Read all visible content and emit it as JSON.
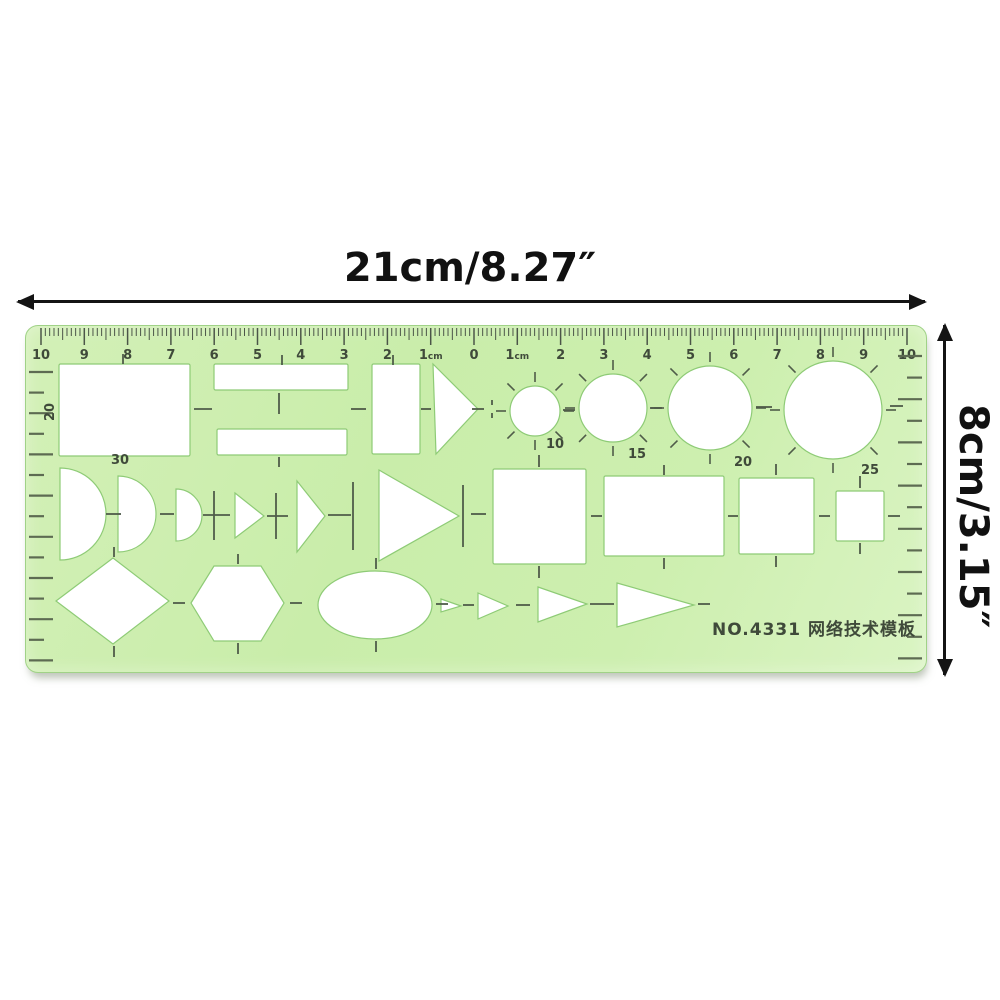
{
  "dimension_labels": {
    "width": "21cm/8.27″",
    "height": "8cm/3.15″"
  },
  "ruler": {
    "model_text": "NO.4331  网络技术模板",
    "model_pos": {
      "x": 788,
      "y": 309
    },
    "colors": {
      "body": "#cdefaf",
      "edge": "#a0d287",
      "tick": "#4b5548",
      "number": "#3f4a3a",
      "edge_tick": "#5d6b52",
      "guide": "#4f5c49",
      "cutout_fill": "#ffffff",
      "cutout_stroke": "#8ecb76"
    },
    "scale": {
      "unit": "cm",
      "origin_x": 448,
      "px_per_cm": 43.3,
      "mm_range": 100,
      "numbers": [
        {
          "cm": -10,
          "t": "10"
        },
        {
          "cm": -9,
          "t": "9"
        },
        {
          "cm": -8,
          "t": "8"
        },
        {
          "cm": -7,
          "t": "7"
        },
        {
          "cm": -6,
          "t": "6"
        },
        {
          "cm": -5,
          "t": "5"
        },
        {
          "cm": -4,
          "t": "4"
        },
        {
          "cm": -3,
          "t": "3"
        },
        {
          "cm": -2,
          "t": "2"
        },
        {
          "cm": -1,
          "t": "1",
          "suffix": "cm"
        },
        {
          "cm": 0,
          "t": "0"
        },
        {
          "cm": 1,
          "t": "1",
          "suffix": "cm"
        },
        {
          "cm": 2,
          "t": "2"
        },
        {
          "cm": 3,
          "t": "3"
        },
        {
          "cm": 4,
          "t": "4"
        },
        {
          "cm": 5,
          "t": "5"
        },
        {
          "cm": 6,
          "t": "6"
        },
        {
          "cm": 7,
          "t": "7"
        },
        {
          "cm": 8,
          "t": "8"
        },
        {
          "cm": 9,
          "t": "9"
        },
        {
          "cm": 10,
          "t": "10"
        }
      ]
    },
    "edge_ticks": {
      "left": {
        "x": 3,
        "y0": 46,
        "step": 20.6,
        "count": 15,
        "len_long": 24,
        "len_short": 15
      },
      "right": {
        "x_end": 896,
        "y0": 30,
        "step": 21.6,
        "count": 15,
        "len_long": 24,
        "len_short": 15
      }
    },
    "cutouts": [
      {
        "type": "rect",
        "x": 33,
        "y": 38,
        "w": 131,
        "h": 92
      },
      {
        "type": "rect",
        "x": 188,
        "y": 38,
        "w": 134,
        "h": 26
      },
      {
        "type": "rect",
        "x": 191,
        "y": 103,
        "w": 130,
        "h": 26
      },
      {
        "type": "rect",
        "x": 346,
        "y": 38,
        "w": 48,
        "h": 90
      },
      {
        "type": "poly",
        "pts": [
          [
            407,
            38
          ],
          [
            452,
            83
          ],
          [
            410,
            128
          ]
        ]
      },
      {
        "type": "circle",
        "cx": 509,
        "cy": 85,
        "r": 25,
        "radial_ticks": true
      },
      {
        "type": "circle",
        "cx": 587,
        "cy": 82,
        "r": 34,
        "radial_ticks": true
      },
      {
        "type": "circle",
        "cx": 684,
        "cy": 82,
        "r": 42,
        "radial_ticks": true
      },
      {
        "type": "circle",
        "cx": 807,
        "cy": 84,
        "r": 49,
        "radial_ticks": true
      },
      {
        "type": "halfcircle",
        "x": 34,
        "cy": 188,
        "r": 46
      },
      {
        "type": "halfcircle",
        "x": 92,
        "cy": 188,
        "r": 38
      },
      {
        "type": "halfcircle",
        "x": 150,
        "cy": 189,
        "r": 26
      },
      {
        "type": "poly",
        "pts": [
          [
            209,
            167
          ],
          [
            238,
            190
          ],
          [
            209,
            212
          ]
        ]
      },
      {
        "type": "poly",
        "pts": [
          [
            271,
            155
          ],
          [
            299,
            190
          ],
          [
            271,
            226
          ]
        ]
      },
      {
        "type": "poly",
        "pts": [
          [
            353,
            144
          ],
          [
            433,
            190
          ],
          [
            353,
            235
          ]
        ]
      },
      {
        "type": "rect",
        "x": 467,
        "y": 143,
        "w": 93,
        "h": 95
      },
      {
        "type": "rect",
        "x": 578,
        "y": 150,
        "w": 120,
        "h": 80
      },
      {
        "type": "rect",
        "x": 713,
        "y": 152,
        "w": 75,
        "h": 76
      },
      {
        "type": "rect",
        "x": 810,
        "y": 165,
        "w": 48,
        "h": 50
      },
      {
        "type": "poly",
        "pts": [
          [
            30,
            275
          ],
          [
            87,
            232
          ],
          [
            143,
            275
          ],
          [
            87,
            318
          ]
        ]
      },
      {
        "type": "poly",
        "pts": [
          [
            165,
            277
          ],
          [
            188,
            240
          ],
          [
            235,
            240
          ],
          [
            258,
            277
          ],
          [
            235,
            315
          ],
          [
            188,
            315
          ]
        ]
      },
      {
        "type": "ellipse",
        "cx": 349,
        "cy": 279,
        "rx": 57,
        "ry": 34
      },
      {
        "type": "poly",
        "pts": [
          [
            415,
            273
          ],
          [
            435,
            280
          ],
          [
            415,
            286
          ]
        ]
      },
      {
        "type": "poly",
        "pts": [
          [
            452,
            267
          ],
          [
            482,
            280
          ],
          [
            452,
            293
          ]
        ]
      },
      {
        "type": "poly",
        "pts": [
          [
            512,
            261
          ],
          [
            561,
            278
          ],
          [
            512,
            296
          ]
        ]
      },
      {
        "type": "poly",
        "pts": [
          [
            591,
            257
          ],
          [
            668,
            279
          ],
          [
            591,
            301
          ]
        ]
      }
    ],
    "guide_ticks": [
      [
        97,
        28,
        97,
        38
      ],
      [
        256,
        29,
        256,
        39
      ],
      [
        367,
        29,
        367,
        39
      ],
      [
        253,
        67,
        253,
        88
      ],
      [
        253,
        131,
        253,
        141
      ],
      [
        168,
        83,
        186,
        83
      ],
      [
        325,
        83,
        340,
        83
      ],
      [
        395,
        83,
        405,
        83
      ],
      [
        446,
        83,
        458,
        83
      ],
      [
        466,
        74,
        466,
        79
      ],
      [
        466,
        87,
        466,
        92
      ],
      [
        537,
        84,
        549,
        84
      ],
      [
        624,
        82,
        636,
        82
      ],
      [
        730,
        81,
        746,
        81
      ],
      [
        864,
        80,
        877,
        80
      ],
      [
        513,
        129,
        513,
        141
      ],
      [
        513,
        240,
        513,
        252
      ],
      [
        638,
        139,
        638,
        149
      ],
      [
        638,
        232,
        638,
        243
      ],
      [
        750,
        138,
        750,
        149
      ],
      [
        750,
        230,
        750,
        241
      ],
      [
        834,
        150,
        834,
        162
      ],
      [
        834,
        217,
        834,
        228
      ],
      [
        445,
        188,
        460,
        188
      ],
      [
        565,
        190,
        576,
        190
      ],
      [
        702,
        190,
        712,
        190
      ],
      [
        793,
        190,
        804,
        190
      ],
      [
        862,
        190,
        874,
        190
      ],
      [
        188,
        165,
        188,
        214
      ],
      [
        177,
        189,
        204,
        189
      ],
      [
        250,
        167,
        250,
        213
      ],
      [
        241,
        190,
        262,
        190
      ],
      [
        327,
        156,
        327,
        224
      ],
      [
        302,
        189,
        325,
        189
      ],
      [
        437,
        159,
        437,
        221
      ],
      [
        80,
        188,
        95,
        188
      ],
      [
        134,
        188,
        148,
        188
      ],
      [
        88,
        221,
        88,
        231
      ],
      [
        88,
        320,
        88,
        331
      ],
      [
        147,
        277,
        159,
        277
      ],
      [
        212,
        228,
        212,
        238
      ],
      [
        212,
        317,
        212,
        328
      ],
      [
        264,
        277,
        276,
        277
      ],
      [
        350,
        232,
        350,
        243
      ],
      [
        350,
        315,
        350,
        326
      ],
      [
        410,
        278,
        422,
        278
      ],
      [
        437,
        279,
        448,
        279
      ],
      [
        490,
        279,
        504,
        279
      ],
      [
        564,
        278,
        588,
        278
      ],
      [
        672,
        278,
        684,
        278
      ]
    ],
    "labels": [
      {
        "t": "20",
        "x": 28,
        "y": 86,
        "rot": -90
      },
      {
        "t": "30",
        "x": 94,
        "y": 138
      },
      {
        "t": "10",
        "x": 529,
        "y": 122
      },
      {
        "t": "15",
        "x": 611,
        "y": 132
      },
      {
        "t": "20",
        "x": 717,
        "y": 140
      },
      {
        "t": "25",
        "x": 844,
        "y": 148
      }
    ]
  }
}
